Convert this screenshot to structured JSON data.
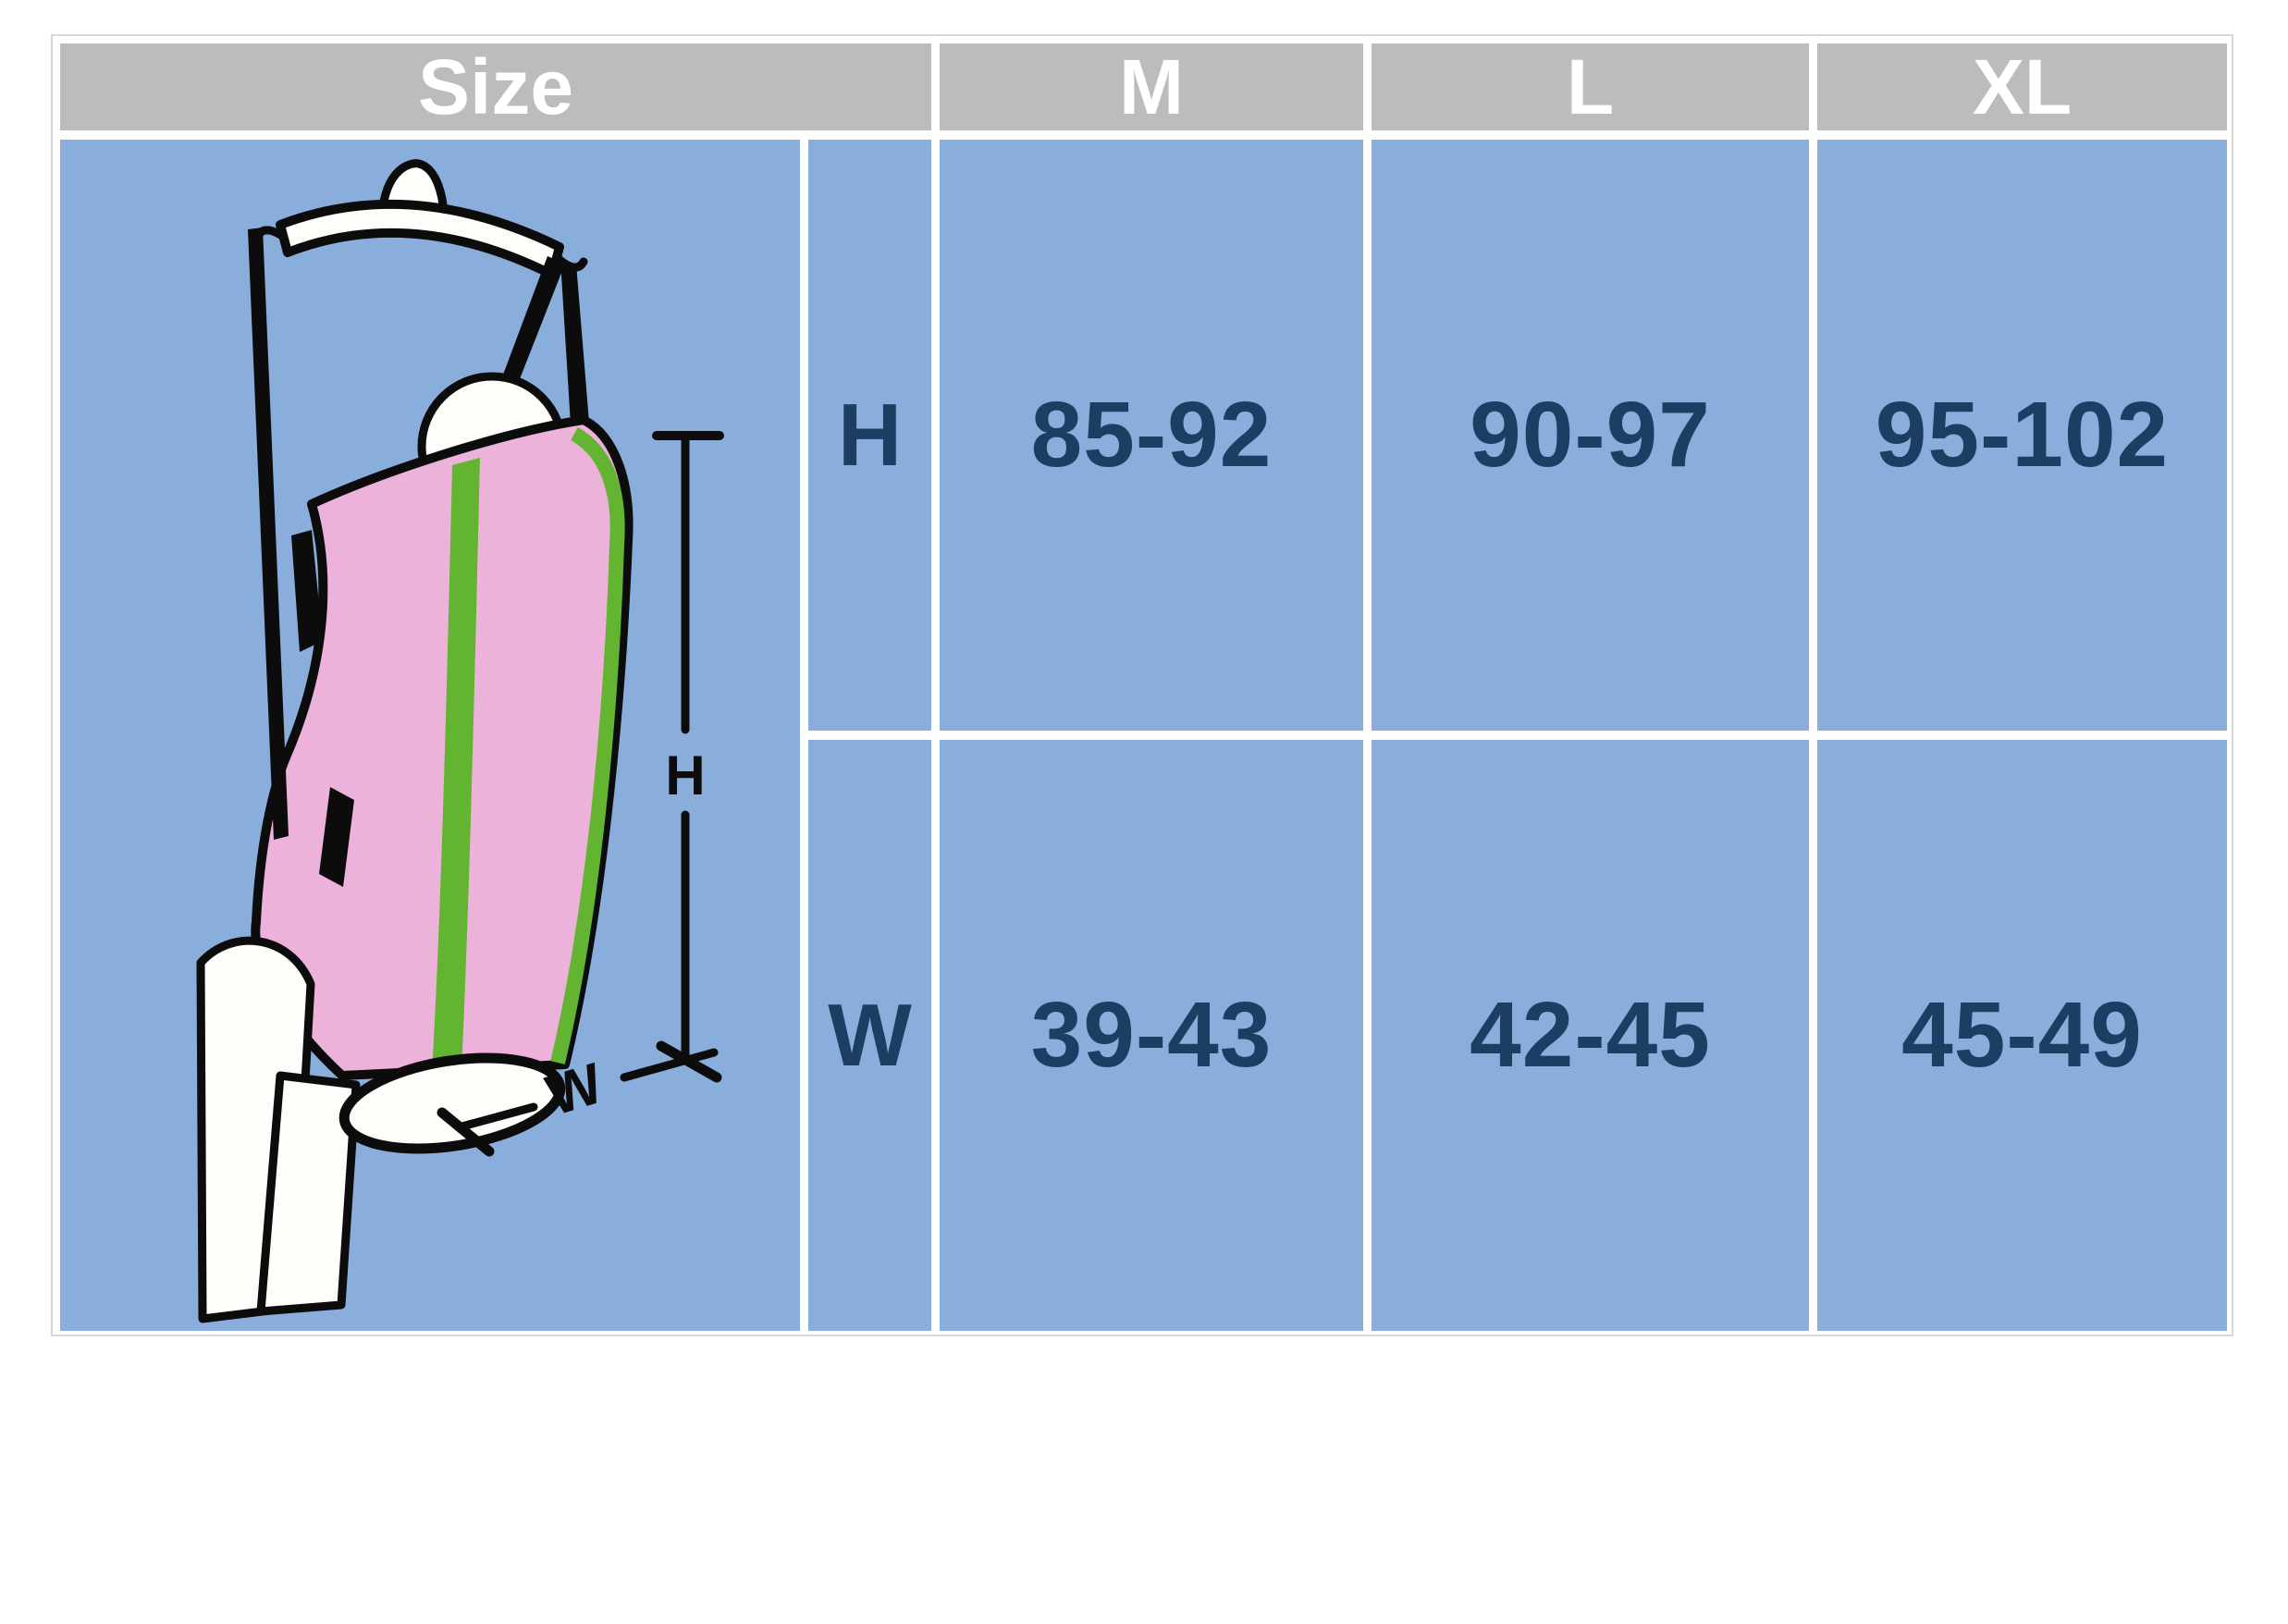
{
  "size_chart": {
    "title": "Size",
    "size_columns": [
      "M",
      "L",
      "XL"
    ],
    "measurement_rows": [
      {
        "label": "H",
        "values": [
          "85-92",
          "90-97",
          "95-102"
        ]
      },
      {
        "label": "W",
        "values": [
          "39-43",
          "42-45",
          "45-49"
        ]
      }
    ]
  },
  "illustration": {
    "height_dimension_label": "H",
    "width_dimension_label": "W"
  },
  "chart_data": {
    "type": "table",
    "title": "Size",
    "columns": [
      "Size",
      "M",
      "L",
      "XL"
    ],
    "rows": [
      [
        "H",
        "85-92",
        "90-97",
        "95-102"
      ],
      [
        "W",
        "39-43",
        "42-45",
        "45-49"
      ]
    ]
  },
  "colors": {
    "page_background": "#ffffff",
    "table_blue": "#8aaedb",
    "header_gray": "#bcbcbc",
    "header_text": "#ffffff",
    "value_navy": "#1d3e63",
    "outline_black": "#0c0c0c",
    "sling_pink": "#edb2da",
    "stripe_green": "#63b431",
    "garment_white": "#fdfdfa",
    "outer_border": "#d8d8d8"
  }
}
